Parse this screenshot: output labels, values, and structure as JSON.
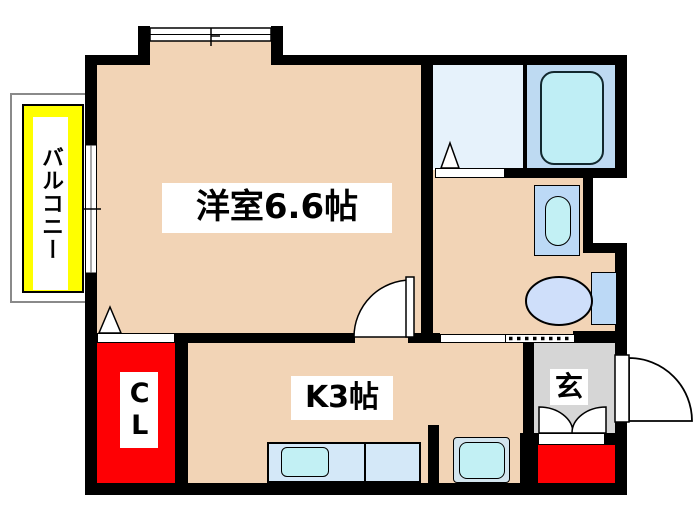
{
  "plan_title": "1K apartment floor plan",
  "labels": {
    "living_room": "洋室6.6帖",
    "kitchen": "K3帖",
    "closet": "CL",
    "entrance": "玄",
    "balcony": "バルコニー"
  },
  "colors": {
    "floor": "#f2d4b6",
    "wall": "#000000",
    "balcony_yellow": "#ffff00",
    "closet_red": "#fe0004",
    "entrance_gray": "#d6d6d6",
    "washroom_blue": "#e6f2fb",
    "bath_blue": "#bedaf2",
    "tub_cyan": "#bfeef5",
    "fixture_blue": "#bcd9f6",
    "toilet_blue": "#cfdffa",
    "counter_blue": "#d4e8f8",
    "sink_cyan": "#c2f0f4",
    "stove_frame": "#d2e4ee"
  },
  "fixtures": {
    "bathtub": "bathtub",
    "vanity": "vanity-sink",
    "toilet": "toilet",
    "counter": "kitchen-counter",
    "kitchen_sink": "kitchen-sink",
    "stove": "stove-space",
    "shoe_cabinet": "shoe-cabinet",
    "entry_door": "entry-door-swing",
    "room_door": "room-door-swing",
    "bay_window": "bay-window",
    "balcony_window": "balcony-window"
  }
}
